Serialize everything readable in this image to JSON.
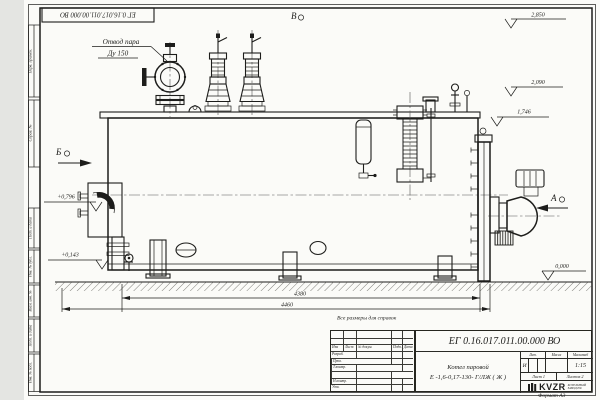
{
  "page": {
    "bg": "#e4e5e2",
    "paper": "#fbfbf8",
    "ink": "#1d1d1b"
  },
  "stamp_top": "ЕГ 0.16.017.011.00.000  ВО",
  "note_reference": "Все размеры для справок",
  "format_label": "Формат А3",
  "margin_labels": [
    "Перв. примен.",
    "Справ. №",
    "Подп. и дата",
    "Инв. № дубл.",
    "Взам. инв. №",
    "Подп. и дата",
    "Инв. № подл."
  ],
  "callouts": {
    "steam_line1": "Отвод пара",
    "steam_line2": "Ду 150"
  },
  "views": {
    "a": "А",
    "b": "Б",
    "v": "В"
  },
  "levels": {
    "l2850": "2,850",
    "l2090": "2,090",
    "l1746": "1,746",
    "l0796": "+0,796",
    "l0143": "+0,143",
    "l0000": "0,000"
  },
  "dims": {
    "overall_top": "4380",
    "overall_bottom": "4460"
  },
  "title_block": {
    "doc_number": "ЕГ 0.16.017.011.00.000  ВО",
    "header_cols": [
      "Изм",
      "Лист",
      "№ докум.",
      "Подп.",
      "Дата"
    ],
    "roles": [
      "Разраб.",
      "Пров.",
      "Т.контр.",
      "",
      "Н.контр.",
      "Утв."
    ],
    "product_line1": "Котел паровой",
    "product_line2": "Е -1,6-0,17-130- Г/ЛЖ ( Ж )",
    "lit_header": "Лит.",
    "mass_header": "Масса",
    "scale_header": "Масштаб",
    "lit_value": "И",
    "mass_value": "",
    "scale_value": "1:15",
    "sheet_label": "Лист  1",
    "sheets_label": "Листов  2",
    "logo_text": "KVZR",
    "company_line1": "КОТЕЛЬНЫЙ",
    "company_line2": "ЗАВОД РФ"
  }
}
